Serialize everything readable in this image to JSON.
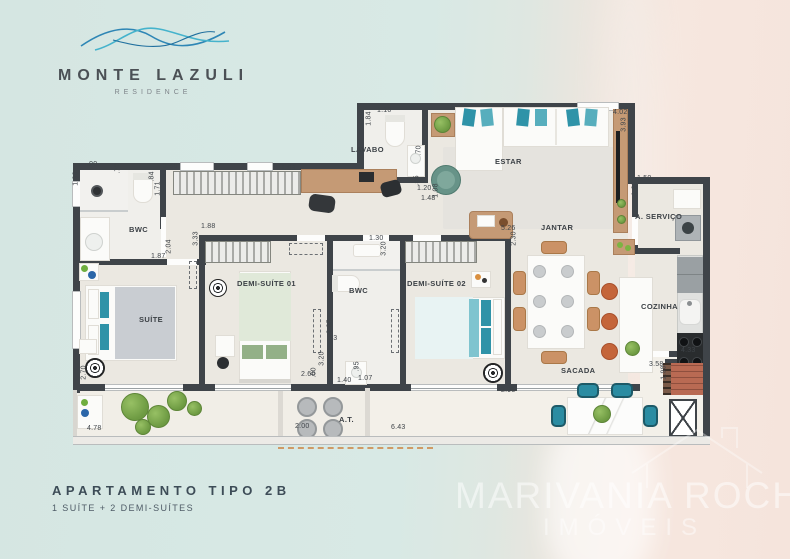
{
  "branding": {
    "name": "MONTE LAZULI",
    "tagline": "RESIDENCE"
  },
  "title_block": {
    "title": "APARTAMENTO TIPO 2B",
    "subtitle": "1 SUÍTE + 2 DEMI-SUÍTES"
  },
  "watermark": {
    "line1": "MARIVANIA ROCHA",
    "line2": "IMÓVEIS"
  },
  "floorplan": {
    "rooms": [
      {
        "label": "BWC",
        "x": 64,
        "y": 130
      },
      {
        "label": "SUÍTE",
        "x": 74,
        "y": 220
      },
      {
        "label": "DEMI-SUÍTE 01",
        "x": 172,
        "y": 184
      },
      {
        "label": "BWC",
        "x": 284,
        "y": 191
      },
      {
        "label": "DEMI-SUÍTE 02",
        "x": 342,
        "y": 184
      },
      {
        "label": "LAVABO",
        "x": 286,
        "y": 50
      },
      {
        "label": "ESTAR",
        "x": 430,
        "y": 62
      },
      {
        "label": "JANTAR",
        "x": 476,
        "y": 128
      },
      {
        "label": "A. SERVIÇO",
        "x": 570,
        "y": 117
      },
      {
        "label": "COZINHA",
        "x": 576,
        "y": 207
      },
      {
        "label": "SACADA",
        "x": 496,
        "y": 271
      },
      {
        "label": "A.T.",
        "x": 274,
        "y": 320
      }
    ],
    "dimensions": [
      {
        "t": ".90",
        "x": 22,
        "y": 66
      },
      {
        "t": "1.90",
        "x": 4,
        "y": 80,
        "r": 1
      },
      {
        "t": ".72",
        "x": 48,
        "y": 70,
        "r": 1
      },
      {
        "t": ".84",
        "x": 82,
        "y": 78,
        "r": 1
      },
      {
        "t": "1.71",
        "x": 86,
        "y": 90,
        "r": 1
      },
      {
        "t": "3.68",
        "x": 98,
        "y": 68
      },
      {
        "t": "1.83",
        "x": 216,
        "y": 70
      },
      {
        "t": "1.88",
        "x": 136,
        "y": 128
      },
      {
        "t": "3.33",
        "x": 124,
        "y": 140,
        "r": 1
      },
      {
        "t": "2.04",
        "x": 97,
        "y": 148,
        "r": 1
      },
      {
        "t": "1.87",
        "x": 86,
        "y": 158
      },
      {
        "t": "2.70",
        "x": 12,
        "y": 274,
        "r": 1
      },
      {
        "t": "4.78",
        "x": 22,
        "y": 330
      },
      {
        "t": "1.10",
        "x": 312,
        "y": 12
      },
      {
        "t": "1.84",
        "x": 297,
        "y": 20,
        "r": 1
      },
      {
        "t": ".70",
        "x": 349,
        "y": 52,
        "r": 1
      },
      {
        "t": ".55",
        "x": 347,
        "y": 82,
        "r": 1
      },
      {
        "t": "1.20",
        "x": 352,
        "y": 90
      },
      {
        "t": "1.48",
        "x": 356,
        "y": 100
      },
      {
        "t": "1.08",
        "x": 364,
        "y": 92,
        "r": 1
      },
      {
        "t": "4.02",
        "x": 548,
        "y": 14
      },
      {
        "t": "3.93",
        "x": 552,
        "y": 26,
        "r": 1
      },
      {
        "t": "1.50",
        "x": 572,
        "y": 80
      },
      {
        "t": "1.60",
        "x": 563,
        "y": 90,
        "r": 1
      },
      {
        "t": "5.26",
        "x": 436,
        "y": 130
      },
      {
        "t": "2.30",
        "x": 442,
        "y": 140,
        "r": 1
      },
      {
        "t": "1.30",
        "x": 304,
        "y": 140
      },
      {
        "t": "3.20",
        "x": 312,
        "y": 150,
        "r": 1
      },
      {
        "t": "2.35",
        "x": 258,
        "y": 228,
        "r": 1
      },
      {
        "t": ".23",
        "x": 262,
        "y": 240
      },
      {
        "t": "3.20",
        "x": 250,
        "y": 260,
        "r": 1
      },
      {
        "t": ".60",
        "x": 244,
        "y": 274,
        "r": 1
      },
      {
        "t": ".95",
        "x": 287,
        "y": 268,
        "r": 1
      },
      {
        "t": "1.07",
        "x": 293,
        "y": 280
      },
      {
        "t": "2.60",
        "x": 236,
        "y": 276
      },
      {
        "t": "1.40",
        "x": 272,
        "y": 282
      },
      {
        "t": "2.95",
        "x": 436,
        "y": 292
      },
      {
        "t": "2.00",
        "x": 230,
        "y": 328
      },
      {
        "t": "6.43",
        "x": 326,
        "y": 329
      },
      {
        "t": "4.33",
        "x": 616,
        "y": 252
      },
      {
        "t": "3.58",
        "x": 584,
        "y": 266
      },
      {
        "t": "1.98",
        "x": 592,
        "y": 274,
        "r": 1
      }
    ]
  },
  "colors": {
    "wall": "#3f4449",
    "floor": "#ebe8e1",
    "wetfloor": "#f0efeb",
    "balcony": "#f3f0e9",
    "teal": "#2f93a8",
    "wood": "#c59a75",
    "green": "#79a84f",
    "terracotta": "#c4653a",
    "brick": "#a65a46",
    "ocean": "#d6e7e3",
    "sand": "#f6e7df",
    "logo_blue_dark": "#2e86b5",
    "logo_blue_light": "#45b3cc",
    "title_text": "#3d4c57"
  }
}
